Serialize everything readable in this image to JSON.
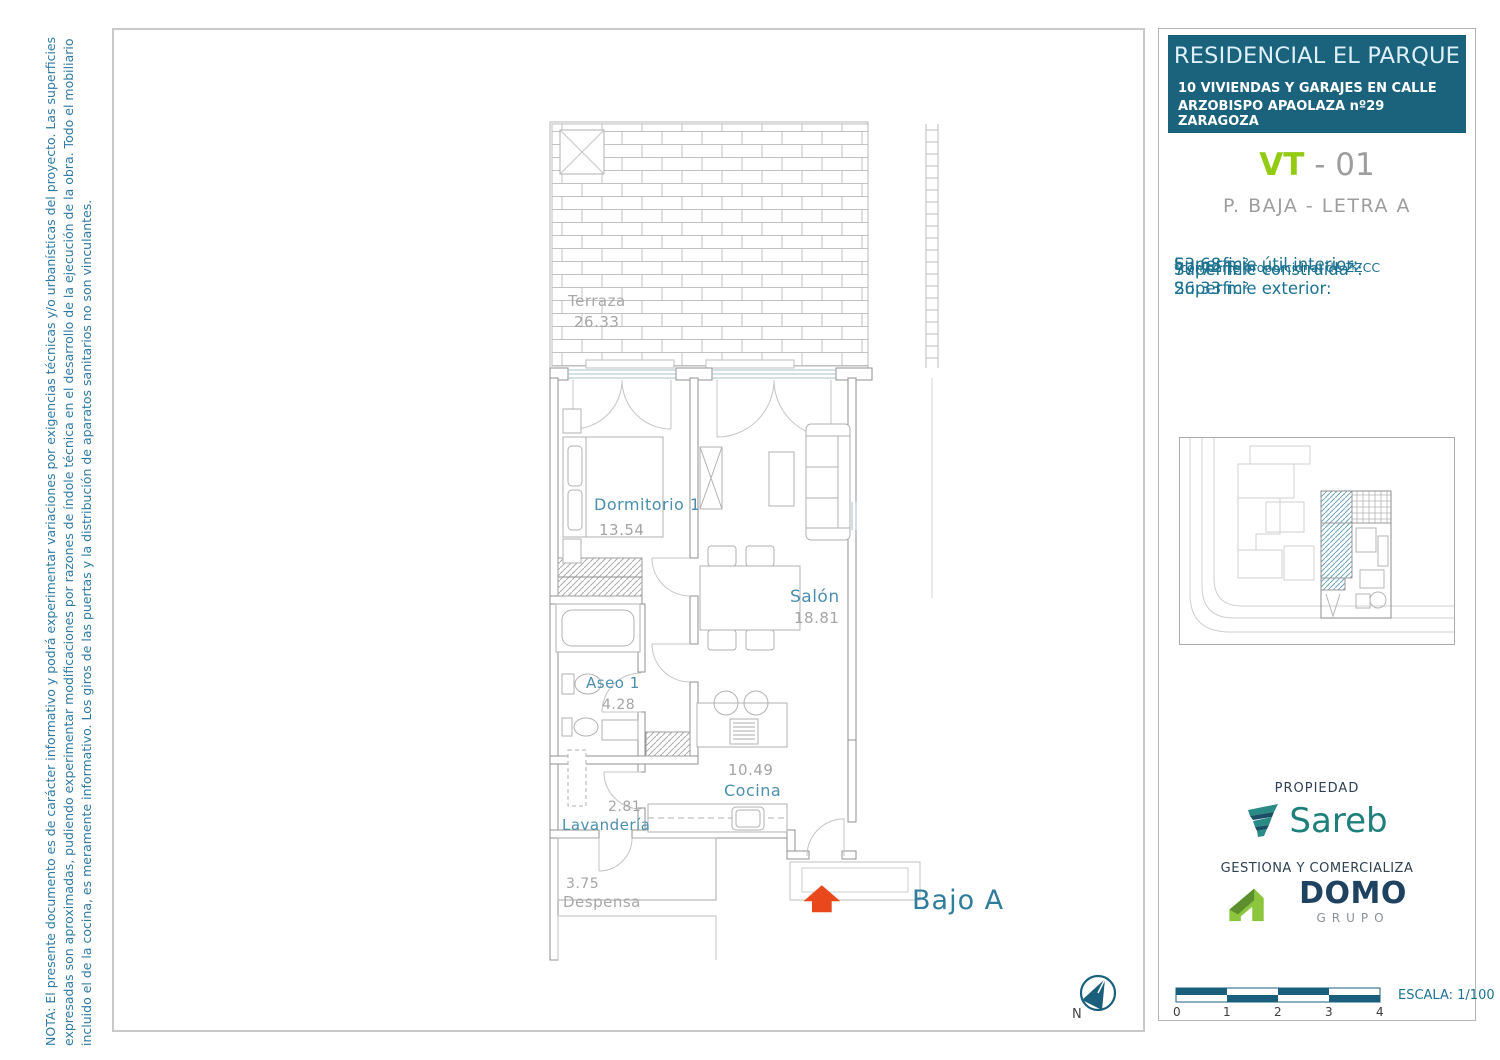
{
  "note": {
    "line1": "NOTA: El presente documento es de carácter informativo y podrá experimentar variaciones por exigencias técnicas y/o urbanísticas del proyecto. Las superficies",
    "line2": "expresadas son aproximadas, pudiendo experimentar modificaciones por razones de índole técnica en el desarrollo de la ejecución de la obra. Todo el mobiliario",
    "line3": "incluido el de la cocina, es meramente informativo. Los giros de las puertas y la distribución de aparatos sanitarios no son vinculantes."
  },
  "plan": {
    "rooms": {
      "terraza": {
        "name": "Terraza",
        "area": "26.33"
      },
      "dormitorio": {
        "name": "Dormitorio 1",
        "area": "13.54"
      },
      "salon": {
        "name": "Salón",
        "area": "18.81"
      },
      "aseo": {
        "name": "Aseo 1",
        "area": "4.28"
      },
      "cocina": {
        "name": "Cocina",
        "area": "10.49"
      },
      "lavanderia": {
        "name": "Lavandería",
        "area": "2.81"
      },
      "despensa": {
        "name": "Despensa",
        "area": "3.75"
      }
    },
    "unit_label": "Bajo A",
    "north_label": "N"
  },
  "panel": {
    "title": "RESIDENCIAL EL PARQUE",
    "subtitle1": "10 VIVIENDAS Y GARAJES EN CALLE",
    "subtitle2": "ARZOBISPO APAOLAZA nº29 ZARAGOZA",
    "unit_code": {
      "prefix": "VT",
      "separator": " - ",
      "number": "01"
    },
    "floor_label": "P. BAJA - LETRA A",
    "surfaces": {
      "util_label": "Superficie útil interior:",
      "util_value": " 53,68 m²",
      "built_label": "Superficie construida*:",
      "built_value": " 77,74 m²",
      "built_note": "*con parte proporcional de ZZCC",
      "exterior_label": "Superficie exterior:",
      "exterior_value": " 26,33 m²"
    },
    "propiedad_label": "PROPIEDAD",
    "sareb_wordmark": "Sareb",
    "gestiona_label": "GESTIONA Y COMERCIALIZA",
    "domo_wordmark": "DOMO",
    "domo_sub": "GRUPO",
    "escala_label": "ESCALA: 1/100",
    "scale_ticks": [
      "0",
      "1",
      "2",
      "3",
      "4"
    ]
  },
  "colors": {
    "header_bg": "#1b627d",
    "panel_teal_text": "#1d7290",
    "room_label_teal": "#4b8fae",
    "muted_gray": "#a5a5a5",
    "vt_green": "#93cb13",
    "code_gray": "#9d9d9d",
    "arrow_red": "#e8481c",
    "sareb_teal": "#1e7f7b",
    "domo_navy": "#1f4260",
    "domo_green": "#8cc63f",
    "scalebar_teal": "#1a5f7c"
  }
}
